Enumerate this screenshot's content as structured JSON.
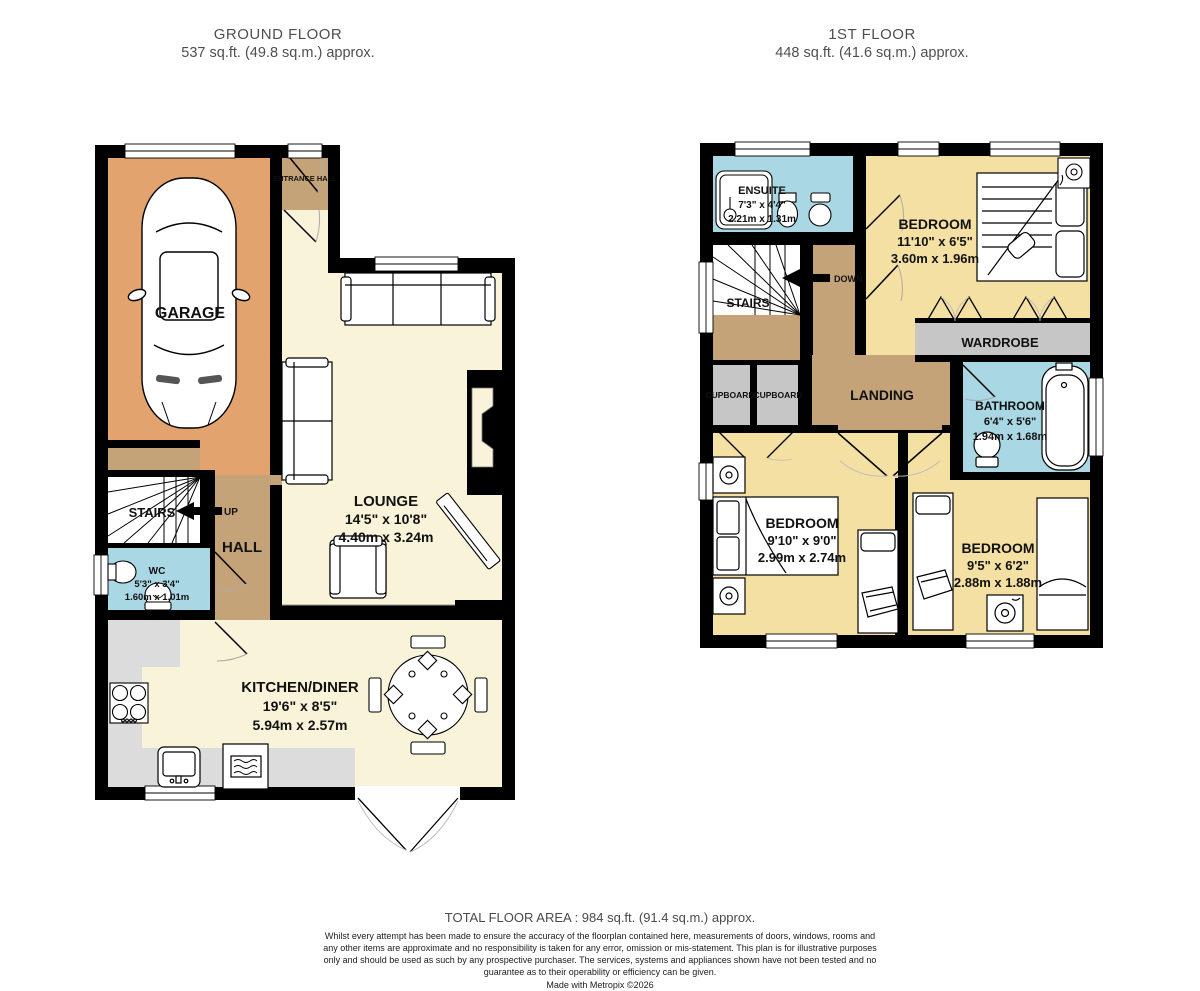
{
  "header": {
    "ground_title": "GROUND FLOOR",
    "ground_area": "537 sq.ft. (49.8 sq.m.) approx.",
    "first_title": "1ST FLOOR",
    "first_area": "448 sq.ft. (41.6 sq.m.) approx."
  },
  "ground_floor": {
    "garage": {
      "name": "GARAGE"
    },
    "entrance_hall": {
      "name": "ENTRANCE HALL"
    },
    "lounge": {
      "name": "LOUNGE",
      "imperial": "14'5\" x 10'8\"",
      "metric": "4.40m x 3.24m"
    },
    "stairs": {
      "name": "STAIRS",
      "direction": "UP"
    },
    "hall": {
      "name": "HALL"
    },
    "wc": {
      "name": "WC",
      "imperial": "5'3\" x 3'4\"",
      "metric": "1.60m x 1.01m"
    },
    "kitchen": {
      "name": "KITCHEN/DINER",
      "imperial": "19'6\" x 8'5\"",
      "metric": "5.94m x 2.57m"
    }
  },
  "first_floor": {
    "ensuite": {
      "name": "ENSUITE",
      "imperial": "7'3\" x 4'4\"",
      "metric": "2.21m x 1.31m"
    },
    "bedroom1": {
      "name": "BEDROOM",
      "imperial": "11'10\" x 6'5\"",
      "metric": "3.60m x 1.96m"
    },
    "wardrobe": {
      "name": "WARDROBE"
    },
    "stairs": {
      "name": "STAIRS",
      "direction": "DOWN"
    },
    "landing": {
      "name": "LANDING"
    },
    "cupboard_left": {
      "name": "CUPBOARD"
    },
    "cupboard_right": {
      "name": "CUPBOARD"
    },
    "bathroom": {
      "name": "BATHROOM",
      "imperial": "6'4\" x 5'6\"",
      "metric": "1.94m x 1.68m"
    },
    "bedroom2": {
      "name": "BEDROOM",
      "imperial": "9'10\" x 9'0\"",
      "metric": "2.99m x 2.74m"
    },
    "bedroom3": {
      "name": "BEDROOM",
      "imperial": "9'5\" x 6'2\"",
      "metric": "2.88m x 1.88m"
    }
  },
  "footer": {
    "total": "TOTAL FLOOR AREA : 984 sq.ft. (91.4 sq.m.) approx.",
    "disclaimer": "Whilst every attempt has been made to ensure the accuracy of the floorplan contained here, measurements of doors, windows, rooms and any other items are approximate and no responsibility is taken for any error, omission or mis-statement. This plan is for illustrative purposes only and should be used as such by any prospective purchaser. The services, systems and appliances shown have not been tested and no guarantee as to their operability or efficiency can be given.",
    "made_with": "Made with Metropix ©2026"
  },
  "colors": {
    "wall": "#000000",
    "garage": "#E2A36F",
    "hallway_tan": "#C5A379",
    "living_cream": "#F8F3D9",
    "bedroom_yellow": "#F5E0A3",
    "wet_room_blue": "#A9D7E3",
    "wardrobe_gray": "#C6C6C6",
    "counter_gray": "#DCDCDC"
  }
}
